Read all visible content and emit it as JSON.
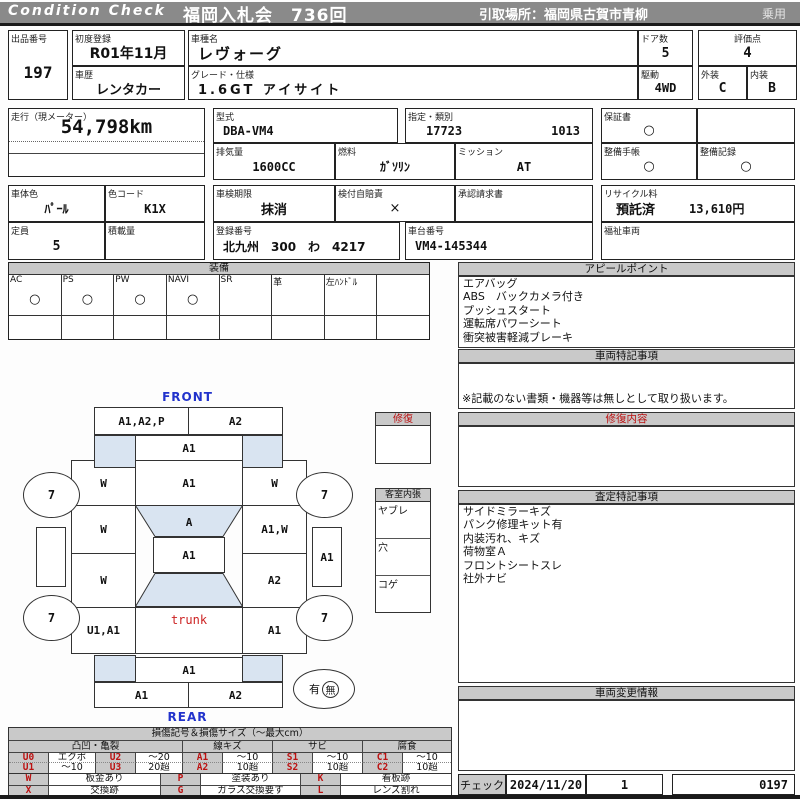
{
  "header": {
    "brand": "Condition Check",
    "auction": "福岡入札会　736回",
    "pickup": "引取場所：福岡県古賀市青柳",
    "category": "乗用"
  },
  "info": {
    "lot_label": "出品番号",
    "lot": "197",
    "first_reg_label": "初度登録",
    "first_reg": "R01年11月",
    "history_label": "車歴",
    "history": "レンタカー",
    "model_label": "車種名",
    "model": "レヴォーグ",
    "grade_label": "グレード・仕様",
    "grade": "1.6GT アイサイト",
    "doors_label": "ドア数",
    "doors": "5",
    "score_label": "評価点",
    "score": "4",
    "drive_label": "駆動",
    "drive": "4WD",
    "exterior_label": "外装",
    "exterior": "C",
    "interior_label": "内装",
    "interior": "B"
  },
  "spec": {
    "mileage_label": "走行（現メーター）",
    "mileage": "54,798km",
    "model_code_label": "型式",
    "model_code": "DBA-VM4",
    "class_label": "指定・類別",
    "class_a": "17723",
    "class_b": "1013",
    "displacement_label": "排気量",
    "displacement": "1600CC",
    "fuel_label": "燃料",
    "fuel": "ｶﾞｿﾘﾝ",
    "transmission_label": "ミッション",
    "transmission": "AT",
    "warranty_label": "保証書",
    "warranty": "○",
    "maintenance_book_label": "整備手帳",
    "maintenance_book": "○",
    "maintenance_record_label": "整備記録",
    "maintenance_record": "○",
    "body_color_label": "車体色",
    "body_color": "ﾊﾟｰﾙ",
    "color_code_label": "色コード",
    "color_code": "K1X",
    "inspection_label": "車検期限",
    "inspection": "抹消",
    "insurance_label": "検付自賠責",
    "insurance": "×",
    "approval_label": "承認請求書",
    "approval": "",
    "capacity_label": "定員",
    "capacity": "5",
    "load_label": "積載量",
    "load": "",
    "reg_number_label": "登録番号",
    "reg_number": "北九州　300　わ　4217",
    "chassis_label": "車台番号",
    "chassis": "VM4-145344",
    "recycle_label": "リサイクル料",
    "recycle_status": "預託済",
    "recycle_fee": "13,610円",
    "welfare_label": "福祉車両",
    "welfare": ""
  },
  "equipment": {
    "title": "装備",
    "items": [
      {
        "label": "AC",
        "value": "○"
      },
      {
        "label": "PS",
        "value": "○"
      },
      {
        "label": "PW",
        "value": "○"
      },
      {
        "label": "NAVI",
        "value": "○"
      },
      {
        "label": "SR",
        "value": ""
      },
      {
        "label": "革",
        "value": ""
      },
      {
        "label": "左ﾊﾝﾄﾞﾙ",
        "value": ""
      },
      {
        "label": "",
        "value": ""
      }
    ]
  },
  "appeal": {
    "title": "アピールポイント",
    "items": [
      "エアバッグ",
      "ABS　バックカメラ付き",
      "プッシュスタート",
      "運転席パワーシート",
      "衝突被害軽減ブレーキ"
    ]
  },
  "vehicle_notes": {
    "title": "車両特記事項",
    "note": "※記載のない書類・機器等は無しとして取り扱います。"
  },
  "repair_content": {
    "title": "修復内容"
  },
  "assessment_notes": {
    "title": "査定特記事項",
    "items": [
      "サイドミラーキズ",
      "パンク修理キット有",
      "内装汚れ、キズ",
      "荷物室Ａ",
      "フロントシートスレ",
      "社外ナビ"
    ]
  },
  "change_info": {
    "title": "車両変更情報"
  },
  "check": {
    "label": "チェック",
    "date": "2024/11/20",
    "count": "1",
    "number": "0197"
  },
  "diagram": {
    "front_label": "FRONT",
    "rear_label": "REAR",
    "front_bumper_left": "A1,A2,P",
    "front_bumper_right": "A2",
    "front_edge": "A1",
    "hood": "A1",
    "windshield": "A",
    "roof": "A1",
    "rear_edge": "A1",
    "rear_bumper_left": "A1",
    "rear_bumper_right": "A2",
    "trunk_label": "trunk",
    "left_front_fender": "W",
    "left_front_door": "W",
    "left_rear_door": "W",
    "left_rear_fender": "U1,A1",
    "right_front_fender": "W",
    "right_front_door": "A1,W",
    "right_rear_door": "A2",
    "right_rear_fender": "A1",
    "right_sill": "A1",
    "tires": [
      "7",
      "7",
      "7",
      "7"
    ],
    "spare_yes": "有",
    "spare_no": "無",
    "repair_box_title": "修復",
    "interior_title": "客室内張",
    "interior_rows": [
      "ヤブレ",
      "穴",
      "コゲ"
    ]
  },
  "legend": {
    "title": "損傷記号＆損傷サイズ（～最大cm）",
    "groups": [
      "凸凹・亀裂",
      "線キズ",
      "サビ",
      "腐食"
    ],
    "codes": [
      {
        "code": "U0",
        "value": "エクボ"
      },
      {
        "code": "U2",
        "value": "～20"
      },
      {
        "code": "A1",
        "value": "～10"
      },
      {
        "code": "S1",
        "value": "～10"
      },
      {
        "code": "C1",
        "value": "～10"
      },
      {
        "code": "U1",
        "value": "～10"
      },
      {
        "code": "U3",
        "value": "20超"
      },
      {
        "code": "A2",
        "value": "10超"
      },
      {
        "code": "S2",
        "value": "10超"
      },
      {
        "code": "C2",
        "value": "10超"
      }
    ],
    "marks": [
      {
        "code": "W",
        "value": "板金あり"
      },
      {
        "code": "P",
        "value": "塗装あり"
      },
      {
        "code": "K",
        "value": "看板跡"
      },
      {
        "code": "X",
        "value": "交換跡"
      },
      {
        "code": "G",
        "value": "ガラス交換要す"
      },
      {
        "code": "L",
        "value": "レンズ割れ"
      }
    ]
  },
  "colors": {
    "header_bg": "#8a8a8a",
    "section_bg": "#c9c9c9",
    "glass_blue": "#d9e4f1",
    "accent_red": "#bb1111",
    "label_blue": "#2233cc"
  }
}
